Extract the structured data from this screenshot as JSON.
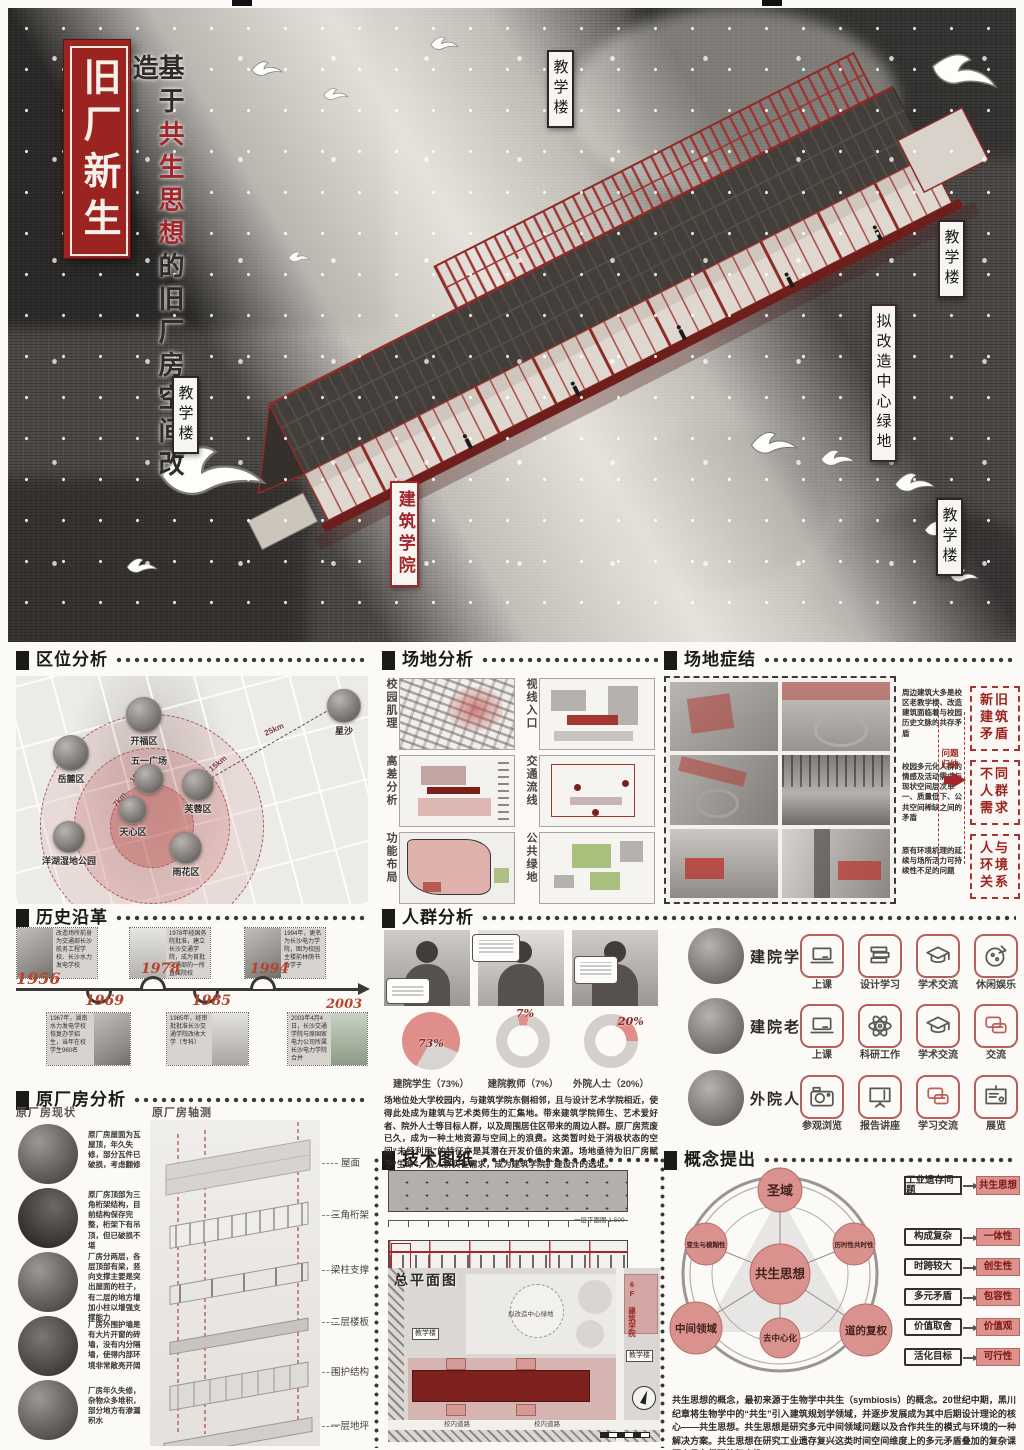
{
  "hero": {
    "title": "旧厂新生",
    "subtitle_prefix": "基于",
    "subtitle_highlight": "共生思想",
    "subtitle_suffix": "的旧厂房空间改造",
    "labels": {
      "teaching_top": "教学楼",
      "teaching_right": "教学楼",
      "teaching_left": "教学楼",
      "teaching_far_right": "教学楼",
      "green": "拟改造中心绿地",
      "college": "建筑学院"
    }
  },
  "location": {
    "title": "区位分析",
    "places": [
      "开福区",
      "五一广场",
      "岳麓区",
      "芙蓉区",
      "天心区",
      "洋湖湿地公园",
      "雨花区",
      "星沙"
    ],
    "distances": [
      "7km",
      "10km",
      "15km",
      "25km"
    ]
  },
  "site_analysis": {
    "title": "场地分析",
    "labels": [
      "校园肌理",
      "视线入口",
      "高差分析",
      "交通流线",
      "功能布局",
      "公共绿地"
    ]
  },
  "site_issues": {
    "title": "场地症结",
    "notes": [
      "周边建筑大多是校区老教学楼、改造建筑面临着与校园历史文脉的共存矛盾",
      "校园多元化人群的情感及活动需求与现状空间层次单一、质量低下、公共空间稀缺之间的矛盾",
      "原有环境机理的延续与场所活力可持续性不足的问题"
    ],
    "arrow_label": "问题归纳",
    "conclusions": [
      "新旧建筑矛盾",
      "不同人群需求",
      "人与环境关系"
    ]
  },
  "history": {
    "title": "历史沿革",
    "years": [
      "1956",
      "1969",
      "1978",
      "1985",
      "1994",
      "2003"
    ],
    "top_cards": [
      "改造场所前身为交通部长沙航务工程学校、长沙水力发电学校",
      "1978年经国务院批准，建立长沙交通学院，成为首批交通部的一所直属院校",
      "1994年，更名为长沙电力学院，图为校园主楼前林荫书香学子"
    ],
    "bottom_cards": [
      "1967年，湖南水力发电学校恢复办学招生，当年在校学生960名",
      "1985年，经审批批准长沙交通学院改收大学（专科）",
      "2003年4月4日，长沙交通学院与原国家电力公司所属长沙电力学院合并"
    ]
  },
  "crowd": {
    "title": "人群分析",
    "pies": [
      {
        "pct": "73%",
        "label": "建院学生（73%）"
      },
      {
        "pct": "7%",
        "label": "建院教师（7%）"
      },
      {
        "pct": "20%",
        "label": "外院人士（20%）"
      }
    ],
    "paragraph": "场地位处大学校园内，与建筑学院东侧相邻，且与设计艺术学院相近，使得此处成为建筑与艺术类师生的汇集地。带来建筑学院师生、艺术爱好者、院外人士等目标人群，以及周围居住区带来的周边人群。原厂房荒废已久，成为一种土地资源与空间上的浪费。这类暂时处于消极状态的空间“未经利用”的特征亦是其潜在开发价值的来源。场地亟待为旧厂房赋予“生命”，应人群实在需求，成为建筑学院扩建设计的选址。",
    "groups": [
      {
        "name": "建院学生",
        "acts": [
          "上课",
          "设计学习",
          "学术交流",
          "休闲娱乐"
        ]
      },
      {
        "name": "建院老师",
        "acts": [
          "上课",
          "科研工作",
          "学术交流",
          "交流"
        ]
      },
      {
        "name": "外院人士",
        "acts": [
          "参观浏览",
          "报告讲座",
          "学习交流",
          "展览"
        ]
      }
    ]
  },
  "factory": {
    "title": "原厂房分析",
    "sub_current": "原厂房现状",
    "sub_axon": "原厂房轴测",
    "notes": [
      "原厂房屋面为瓦屋顶，年久失修，部分瓦件已破损，考虑翻修",
      "原厂房顶部为三角桁架结构，目前结构保存完整，桁架下有吊顶，但已破损不堪",
      "厂房分两层，各层顶部有梁，竖向支撑主要是突出屋面的柱子，有二层的地方增加小柱以增强支撑能力",
      "厂房外围护墙是有大片开窗的砖墙，没有内分隔墙，使得内部环境非常敞亮开阔",
      "厂房年久失修，杂物众多堆积，部分地方有渗漏积水"
    ],
    "axon_labels": [
      "屋面",
      "三角桁架",
      "梁柱支撑",
      "二层楼板",
      "围护结构",
      "一层地坪"
    ]
  },
  "drawings": {
    "title": "技术图纸",
    "plan_caption": "一层平面图 1:500",
    "section_caption": "1-1剖面图 1:500",
    "master_label": "总平面图",
    "site_labels": {
      "green": "拟改造中心绿地",
      "teach_left": "教学楼",
      "college": "6F 建筑学院",
      "teach_right": "教学楼",
      "road1": "校内道路",
      "road2": "校内道路"
    }
  },
  "concept": {
    "title": "概念提出",
    "center": "共生思想",
    "nodes": {
      "top": "圣域",
      "left": "变生与模糊性",
      "right": "历时性共时性",
      "bottom": "去中心化",
      "bottom_left": "中间领域",
      "bottom_right": "道的复权"
    },
    "flow_from": "工业遗存问题",
    "flow_to": "共生思想",
    "pairs": [
      {
        "from": "构成复杂",
        "to": "一体性"
      },
      {
        "from": "时跨较大",
        "to": "创生性"
      },
      {
        "from": "多元矛盾",
        "to": "包容性"
      },
      {
        "from": "价值取舍",
        "to": "价值观"
      },
      {
        "from": "活化目标",
        "to": "可行性"
      }
    ],
    "paragraph": "共生思想的概念，最初来源于生物学中共生（symbiosis）的概念。20世纪中期，黑川纪章将生物学中的“共生”引入建筑规划学领域，并逐步发展成为其中后期设计理论的核心——共生思想。共生思想是研究多元中间领域问题以及合作共生的模式与环境的一种解决方案。共生思想在研究工业遗存复兴这类时间空间维度上的多元矛盾叠加的复杂课题中具有很强的契合性。"
  },
  "chart_data": [
    {
      "type": "pie",
      "title": "人群构成",
      "labels": [
        "建院学生",
        "建院教师",
        "外院人士"
      ],
      "values": [
        73,
        7,
        20
      ],
      "legend_position": "below",
      "colors": [
        "#dd928e",
        "#d3d0cc"
      ]
    }
  ],
  "colors": {
    "accent": "#9c2420",
    "pink": "#dd928e",
    "paper": "#f6f4f0",
    "ink": "#1c1a19"
  }
}
